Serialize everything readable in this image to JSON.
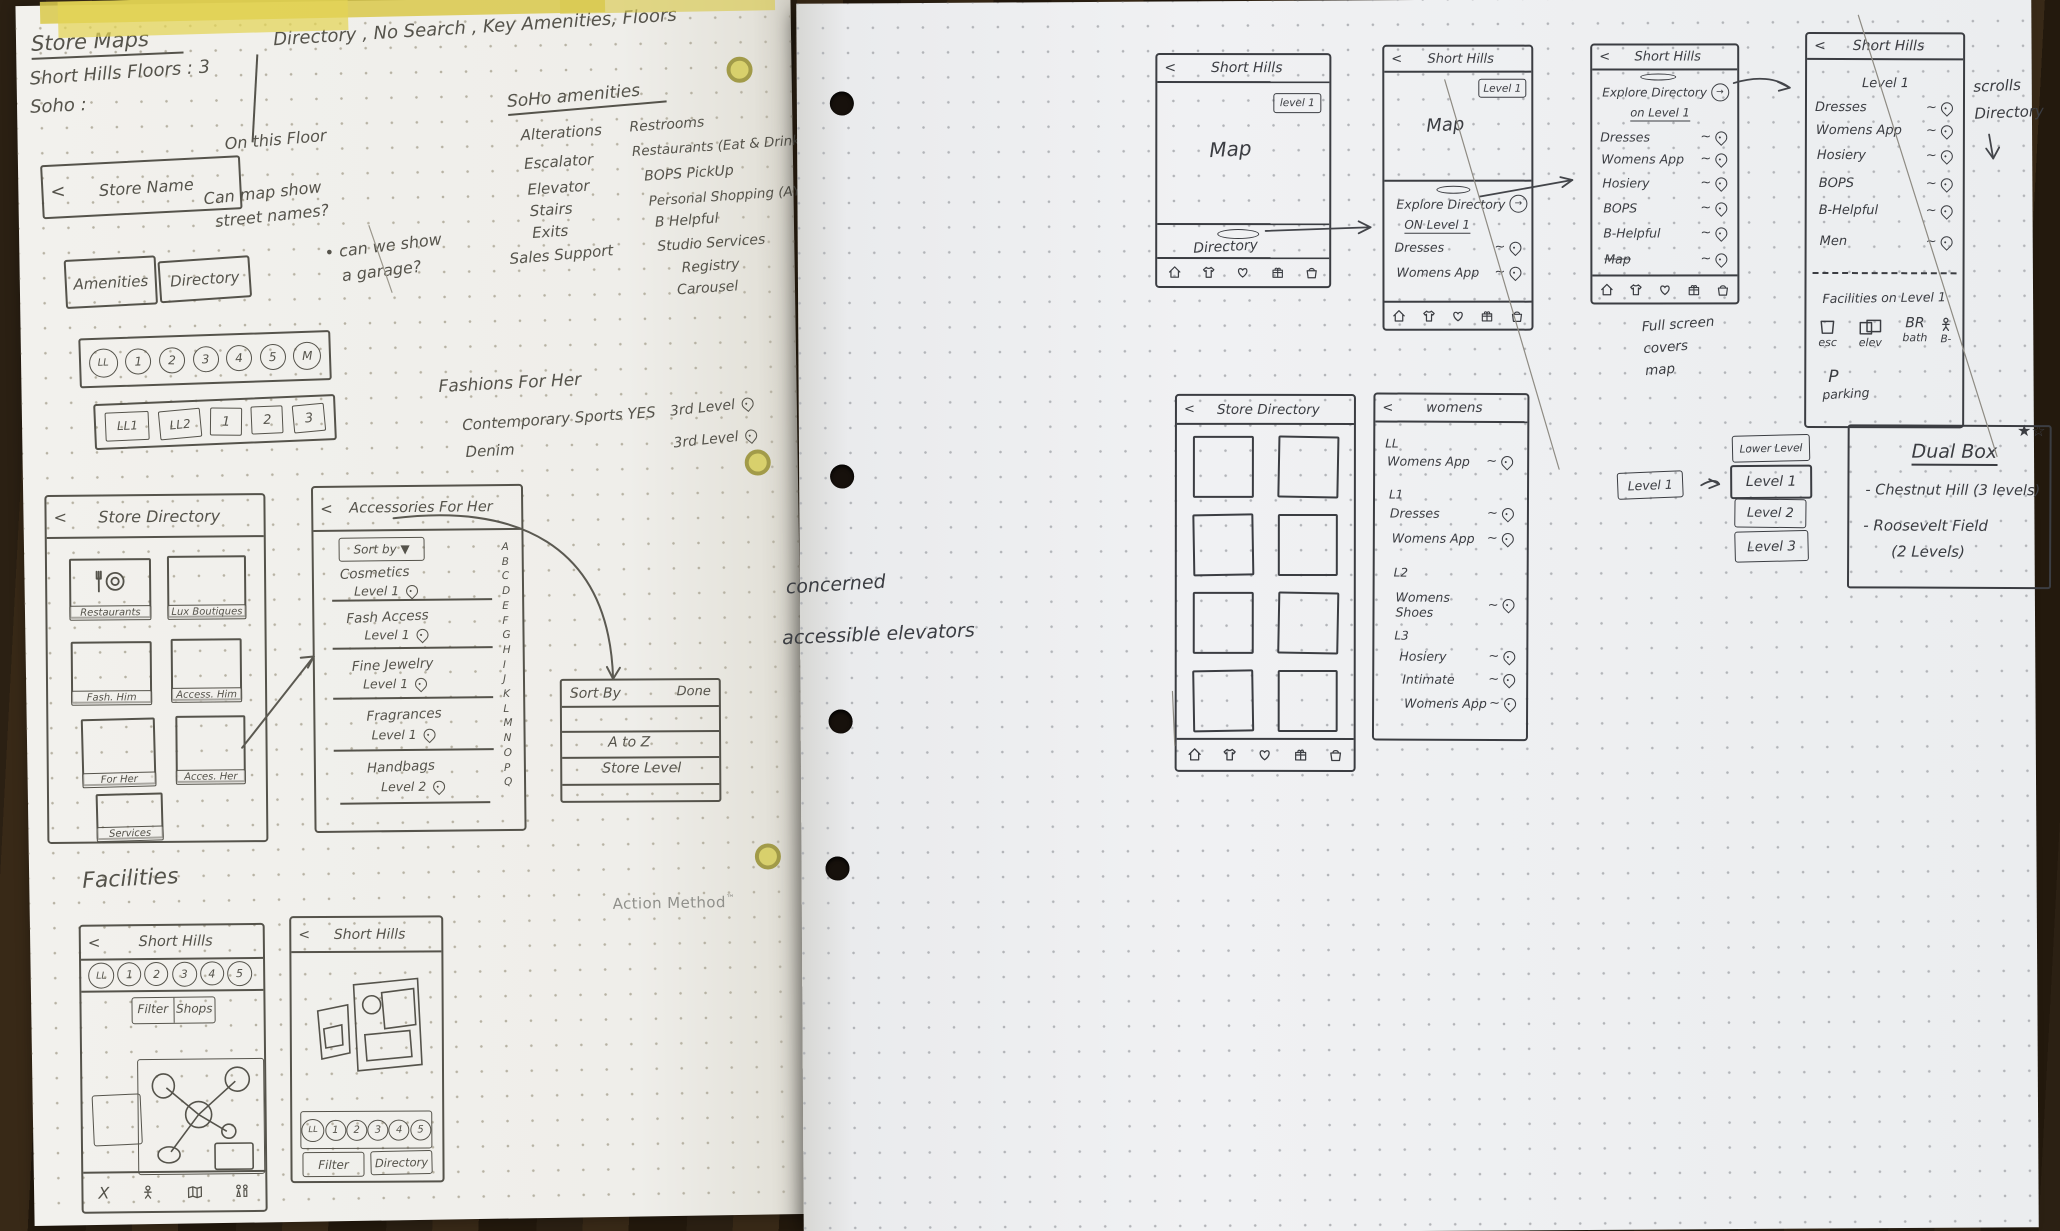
{
  "brand": {
    "name": "Action Method",
    "tm": "™"
  },
  "icons": {
    "back": "<",
    "circle_arrow": "→",
    "glyph_names": {
      "pin": "location-pin-icon",
      "tab_bar": [
        "home-icon",
        "shirt-icon",
        "heart-icon",
        "gift-icon",
        "bag-icon"
      ],
      "fac1_bar": [
        "close-icon",
        "person-icon",
        "map-icon",
        "restroom-icon"
      ],
      "restaurants_card": "fork-and-plate-icon",
      "facility_row": [
        "escalator-square-icon",
        "elevator-double-square-icon",
        "restroom-text-icon",
        "person-icon"
      ]
    }
  },
  "left_page": {
    "title": "Store Maps",
    "line2": "Short Hills Floors : 3",
    "line3": "Soho :",
    "header_note": "Directory , No Search , Key Amenities, Floors",
    "notes": {
      "on_floor": "On this Floor",
      "q1a": "Can map show",
      "q1b": "street names?",
      "q2a": "• can we show",
      "q2b": "a garage?"
    },
    "amenities": {
      "title": "SoHo amenities",
      "col1": [
        "Alterations",
        "Escalator",
        "Elevator",
        "Stairs",
        "Exits",
        "Sales Support"
      ],
      "col2": [
        "Restrooms",
        "Restaurants (Eat & Drink)",
        "BOPS PickUp",
        "Personal Shopping (AYS)",
        "B Helpful",
        "Studio Services",
        "Registry",
        "Carousel"
      ]
    },
    "store_name_bar": {
      "title": "Store Name"
    },
    "buttons": {
      "amenities": "Amenities",
      "directory": "Directory"
    },
    "levels_round": [
      "LL",
      "1",
      "2",
      "3",
      "4",
      "5",
      "M"
    ],
    "levels_square": [
      "LL1",
      "LL2",
      "1",
      "2",
      "3"
    ],
    "fashions": {
      "title": "Fashions For Her",
      "row1": {
        "label": "Contemporary Sports YES",
        "level": "3rd Level"
      },
      "row2": {
        "label": "Denim",
        "level": "3rd Level"
      }
    },
    "store_directory": {
      "title": "Store Directory",
      "cards": [
        "Restaurants",
        "Lux Boutiques",
        "Fash. Him",
        "Access. Him",
        "For Her",
        "Acces. Her",
        "Services"
      ]
    },
    "accessories": {
      "title": "Accessories For Her",
      "sort_button": "Sort by ▼",
      "items": [
        {
          "name": "Cosmetics",
          "level": "Level 1"
        },
        {
          "name": "Fash Access",
          "level": "Level 1"
        },
        {
          "name": "Fine Jewelry",
          "level": "Level 1"
        },
        {
          "name": "Fragrances",
          "level": "Level 1"
        },
        {
          "name": "Handbags",
          "level": "Level 2"
        }
      ],
      "alpha": "A\nB\nC\nD\nE\nF\nG\nH\nI\nJ\nK\nL\nM\nN\nO\nP\nQ"
    },
    "sort_dialog": {
      "title": "Sort By",
      "done": "Done",
      "opt1": "A to Z",
      "opt2": "Store Level"
    },
    "facilities_label": "Facilities",
    "fac1": {
      "title": "Short Hills",
      "pills": [
        "LL",
        "1",
        "2",
        "3",
        "4",
        "5"
      ],
      "filter": "Filter",
      "shops": "Shops",
      "close": "X"
    },
    "fac2": {
      "title": "Short Hills",
      "pills": [
        "LL",
        "1",
        "2",
        "3",
        "4",
        "5"
      ],
      "filter": "Filter",
      "directory": "Directory"
    }
  },
  "right_page": {
    "margin_note1": "concerned",
    "margin_note2": "accessible elevators",
    "phone_a": {
      "title": "Short Hills",
      "badge": "level 1",
      "map": "Map",
      "directory": "Directory"
    },
    "phone_b": {
      "title": "Short Hills",
      "badge": "Level 1",
      "map": "Map",
      "explore": "Explore Directory",
      "on_level": "ON Level 1",
      "items": [
        "Dresses",
        "Womens App"
      ]
    },
    "phone_c": {
      "title": "Short Hills",
      "explore": "Explore Directory",
      "on_level": "on Level 1",
      "items": [
        "Dresses",
        "Womens App",
        "Hosiery",
        "BOPS",
        "B-Helpful",
        "Map"
      ]
    },
    "fullscreen_note": "Full screen\ncovers\nmap",
    "phone_d": {
      "title": "Short Hills",
      "level": "Level 1",
      "items": [
        "Dresses",
        "Womens App",
        "Hosiery",
        "BOPS",
        "B-Helpful",
        "Men"
      ],
      "facilities": "Facilities on Level 1",
      "fac": {
        "esc": "esc",
        "elev": "elev",
        "br": "BR",
        "bath": "bath",
        "person_label": "B-"
      },
      "parking_p": "P",
      "parking": "parking"
    },
    "scroll_note": "scrolls\nDirectory",
    "directory2": {
      "title": "Store Directory"
    },
    "womens": {
      "title": "womens",
      "sections": [
        {
          "level": "LL",
          "items": [
            "Womens App"
          ]
        },
        {
          "level": "L1",
          "items": [
            "Dresses",
            "Womens App"
          ]
        },
        {
          "level": "L2",
          "items": [
            "Womens Shoes"
          ]
        },
        {
          "level": "L3",
          "items": [
            "Hosiery",
            "Intimate",
            "Womens App"
          ]
        }
      ]
    },
    "level_picker": {
      "trigger": "Level 1",
      "options": [
        "Lower Level",
        "Level 1",
        "Level 2",
        "Level 3"
      ]
    },
    "dual_box": {
      "title": "Dual Box",
      "stars": "★☆",
      "line1": "- Chestnut Hill (3 levels)",
      "line2": "- Roosevelt Field",
      "line3": "(2 Levels)"
    }
  }
}
